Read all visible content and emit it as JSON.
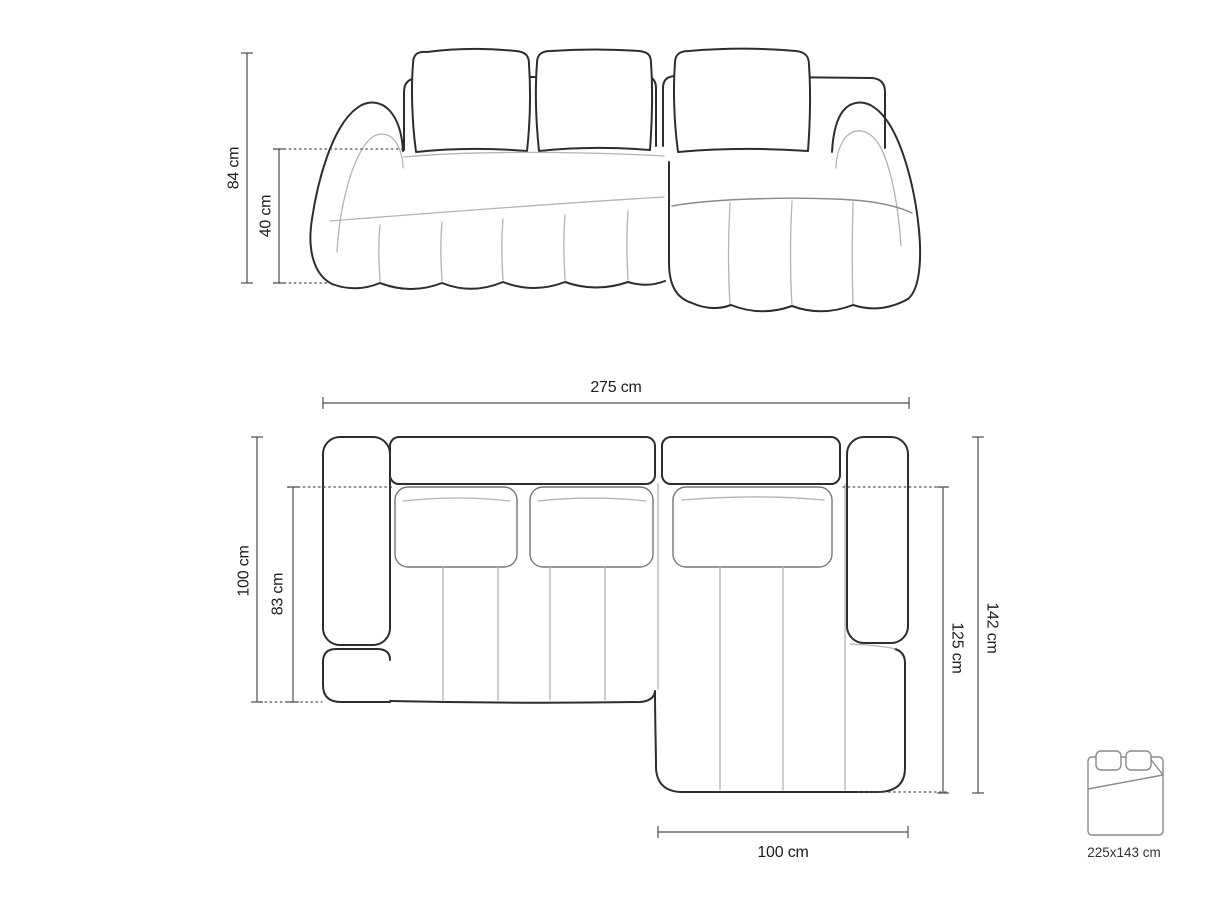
{
  "front_view": {
    "height_label": "84 cm",
    "seat_height_label": "40 cm"
  },
  "top_view": {
    "total_width_label": "275 cm",
    "total_depth_label": "100 cm",
    "seat_depth_label": "83 cm",
    "chaise_total_depth_label": "142 cm",
    "chaise_depth_label": "125 cm",
    "chaise_width_label": "100 cm"
  },
  "sleeping_function": {
    "bed_size_label": "225x143 cm"
  },
  "dimensions_cm": {
    "height": 84,
    "seat_height": 40,
    "total_width": 275,
    "total_depth": 100,
    "seat_depth": 83,
    "chaise_total_depth": 142,
    "chaise_depth": 125,
    "chaise_width": 100,
    "sleeping_area": "225x143"
  },
  "colors": {
    "background": "#ffffff",
    "outline": "#2d2d2d",
    "seam": "#b3b3b3",
    "cushion_edge": "#757575",
    "dimension_line": "#4d4d4d",
    "text": "#1d1d1d"
  }
}
